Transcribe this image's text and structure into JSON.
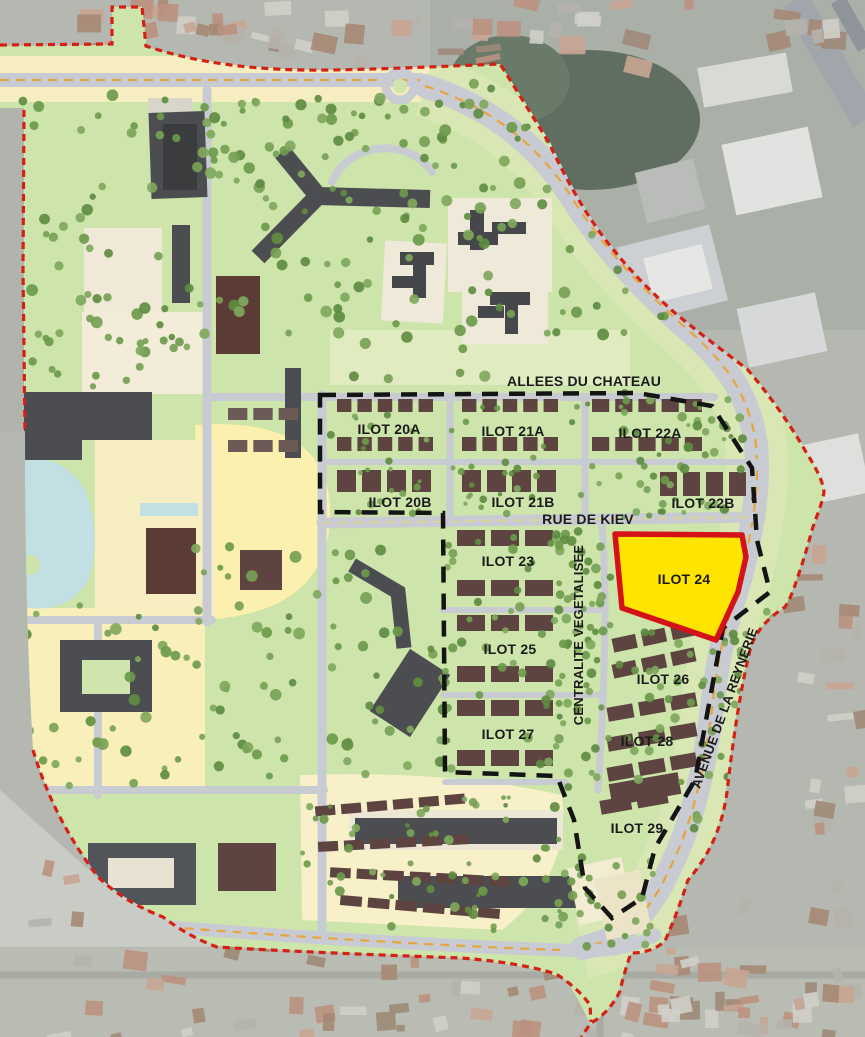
{
  "map_labels": {
    "allees_du_chateau": "ALLEES DU CHATEAU",
    "ilot_20a": "ILOT 20A",
    "ilot_21a": "ILOT 21A",
    "ilot_22a": "ILOT 22A",
    "ilot_20b": "ILOT 20B",
    "ilot_21b": "ILOT 21B",
    "ilot_22b": "ILOT 22B",
    "rue_de_kiev": "RUE DE KIEV",
    "ilot_23": "ILOT 23",
    "ilot_24": "ILOT 24",
    "ilot_25": "ILOT 25",
    "ilot_26": "ILOT 26",
    "ilot_27": "ILOT 27",
    "ilot_28": "ILOT 28",
    "ilot_29": "ILOT 29",
    "centralite_vegetalisee": "CENTRALITE VEGETALISEE",
    "avenue_de_la_reynerie": "AVENUE DE LA REYNERIE"
  },
  "colors": {
    "highlight_fill": "#FFE400",
    "highlight_border": "#D41217",
    "site_boundary_red": "#D42015",
    "study_boundary_black": "#141414",
    "plan_green": "#cde4ab",
    "water_blue": "#c2dfe3",
    "road_gray": "#c8ccd2",
    "building_dark": "#4b4d50",
    "building_brown": "#5d4440",
    "tree_green": "#6d9a4b"
  }
}
